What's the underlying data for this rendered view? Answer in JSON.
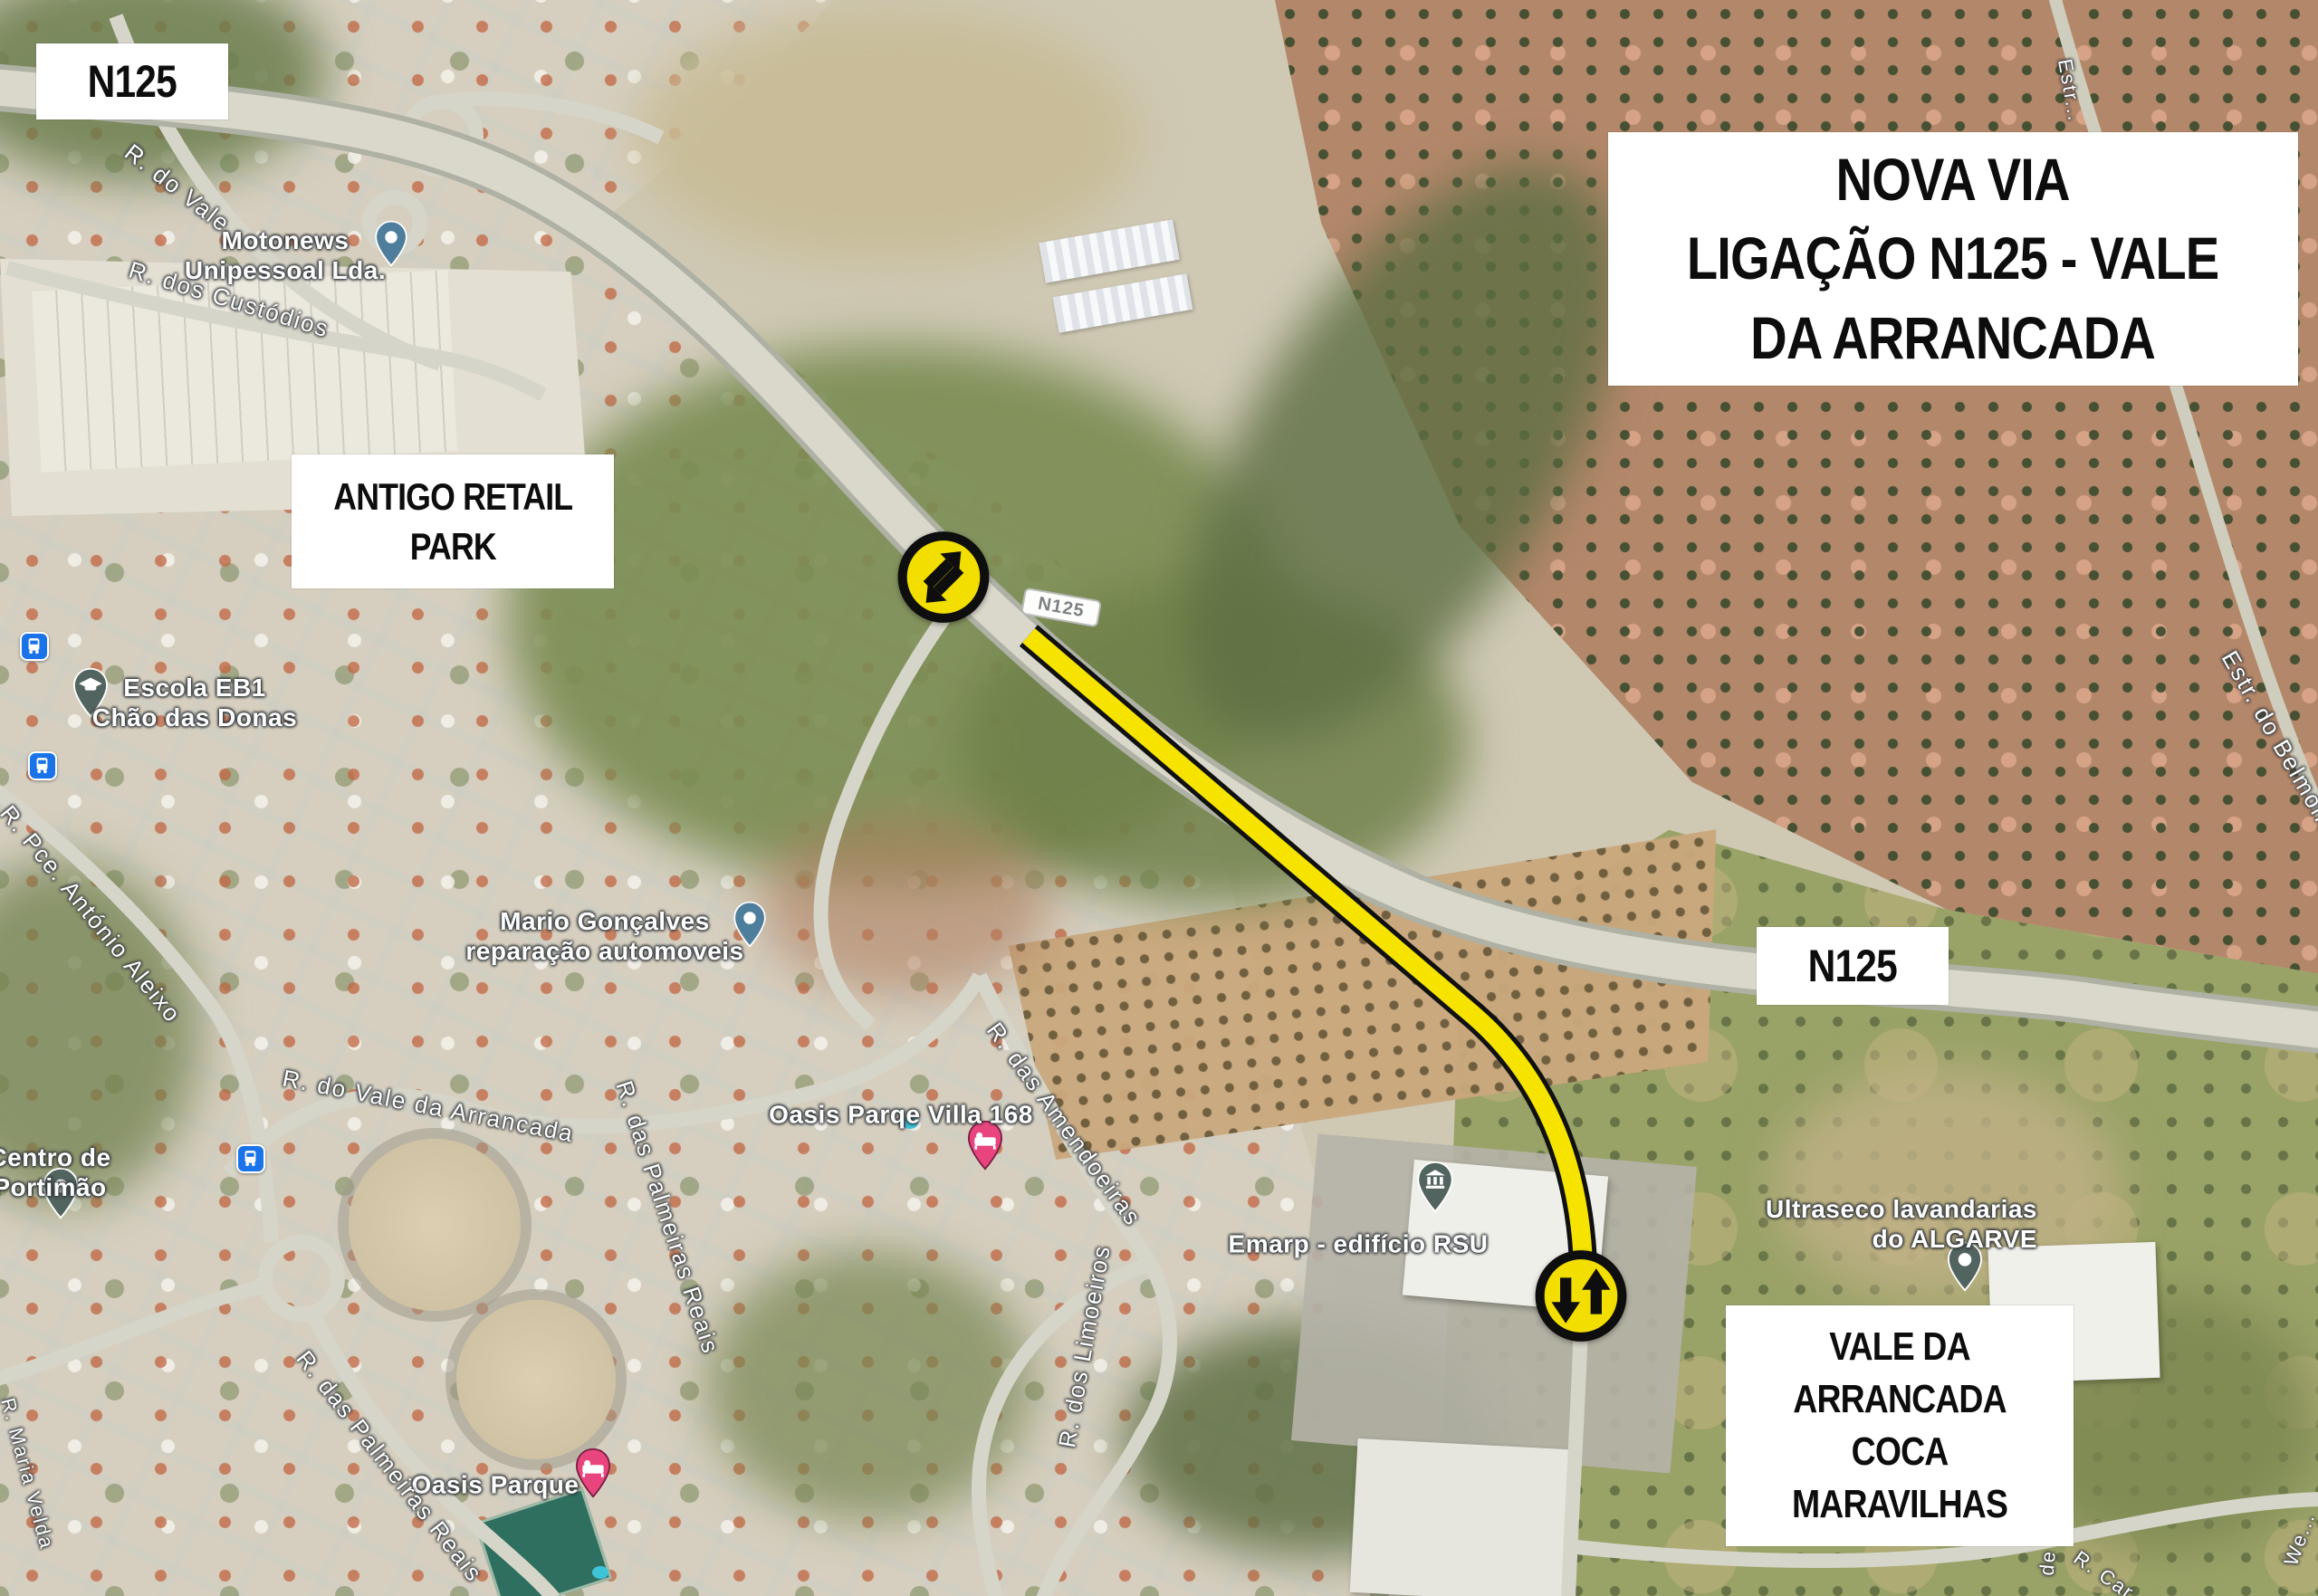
{
  "boxes": {
    "n125_top": "N125",
    "title": "NOVA VIA\nLIGAÇÃO N125 - VALE\nDA ARRANCADA",
    "antigo": "ANTIGO RETAIL\nPARK",
    "n125_mid": "N125",
    "vale": "VALE DA\nARRANCADA\nCOCA\nMARAVILHAS"
  },
  "road_shield": "N125",
  "places": {
    "motonews": "Motonews\nUnipessoal Lda.",
    "escola": "Escola EB1\nChão das Donas",
    "mario": "Mario Gonçalves\nreparação automoveis",
    "villa168": "Oasis Parqe Villa 168",
    "emarp": "Emarp - edifício RSU",
    "ultraseco": "Ultraseco lavandarias\ndo ALGARVE",
    "centro": "Centro de\nPortimão",
    "oasis": "Oasis Parque"
  },
  "streets": {
    "do_vale": "R. do Vale",
    "custodios": "R. dos Custódios",
    "aleixo": "R. Pce. António Aleixo",
    "vale_arrancada": "R. do Vale da Arrancada",
    "palmeiras_mid": "R. das Palmeiras Reais",
    "palmeiras_low": "R. das Palmeiras Reais",
    "amendoeiras": "R. das Amendoeiras",
    "limoeiros": "R. dos Limoeiros",
    "belmonte": "Estr. do Belmonte",
    "estr_top": "Estr...",
    "de_m": "de M",
    "r_car": "R. Car...",
    "we": "We...",
    "maria": "R. Maria Velda"
  },
  "icons": {
    "traffic_icon_1": "two-way-traffic-arrows-diagonal",
    "traffic_icon_2": "two-way-traffic-arrows-vertical",
    "bus_stops": "bus-stop-icon",
    "pin_motonews": "blue-place-pin",
    "pin_mario": "blue-place-pin",
    "pin_escola": "school-pin",
    "pin_villa168": "lodging-pin-pink",
    "pin_oasis": "lodging-pin-pink",
    "pin_emarp": "public-building-pin",
    "pin_ultraseco": "place-pin-slate",
    "pin_centro": "place-pin-slate"
  },
  "colors": {
    "highlight_yellow": "#F6E400",
    "icon_yellow": "#F2DE00",
    "outline_black": "#111111",
    "box_bg": "#FFFFFF",
    "box_text": "#0D0D0D",
    "bus_blue": "#1A73E8",
    "pin_blue": "#4E7E9C",
    "pin_pink": "#E8457E",
    "pin_slate": "#52645F",
    "label_white": "#FFFFFF"
  }
}
